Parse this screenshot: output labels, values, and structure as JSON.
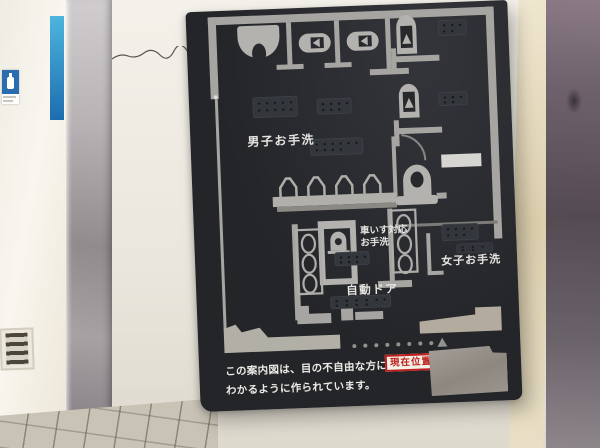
{
  "sign": {
    "labels": {
      "mens": "男子お手洗",
      "wheelchair_line1": "車いす対応",
      "wheelchair_line2": "お手洗",
      "womens": "女子お手洗",
      "auto_door": "自動ドア",
      "current_location": "現在位置"
    },
    "caption": {
      "line1": "この案内図は、目の不自由な方にも",
      "line2": "わかるように作られています。"
    },
    "colors": {
      "board_bg": "#27292d",
      "map_line": "#a6a5a1",
      "fixture": "#b3b2ae",
      "text": "#e8e7e3",
      "accent_red": "#bf1f1c",
      "location_label_bg": "#f3f0e8"
    }
  },
  "environment": {
    "wall_sign_blue": "#2a6cb0",
    "blue_stripe": "#2f9ccf",
    "pillar_cream": "#e9dfc4",
    "metal_door_dark": "#5c525a"
  }
}
